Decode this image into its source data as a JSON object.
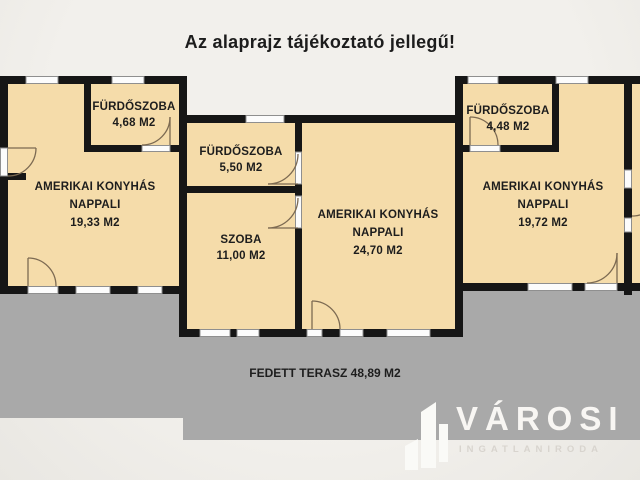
{
  "title": "Az alaprajz tájékoztató jellegű!",
  "colors": {
    "background": "#efede9",
    "room_fill": "#f5dcaa",
    "wall": "#161616",
    "terrace_gray": "#a9a9a9",
    "window_fill": "#fcfcfc",
    "door_arc": "#7c6a52",
    "label_text": "#1d1d1d",
    "logo_white": "#f8f6f3",
    "logo_subtitle": "#d8d4ce"
  },
  "units": {
    "left": {
      "bathroom": {
        "name": "FÜRDŐSZOBA",
        "area": "4,68 M2"
      },
      "living": {
        "line1": "AMERIKAI KONYHÁS",
        "line2": "NAPPALI",
        "area": "19,33 M2"
      }
    },
    "middle": {
      "bathroom": {
        "name": "FÜRDŐSZOBA",
        "area": "5,50 M2"
      },
      "room": {
        "name": "SZOBA",
        "area": "11,00 M2"
      },
      "living": {
        "line1": "AMERIKAI KONYHÁS",
        "line2": "NAPPALI",
        "area": "24,70 M2"
      }
    },
    "right": {
      "bathroom": {
        "name": "FÜRDŐSZOBA",
        "area": "4,48 M2"
      },
      "living": {
        "line1": "AMERIKAI KONYHÁS",
        "line2": "NAPPALI",
        "area": "19,72 M2"
      }
    }
  },
  "terrace": {
    "name": "FEDETT TERASZ",
    "area": "48,89 M2"
  },
  "logo": {
    "brand": "VÁROSI",
    "subtitle": "INGATLANIRODA"
  }
}
